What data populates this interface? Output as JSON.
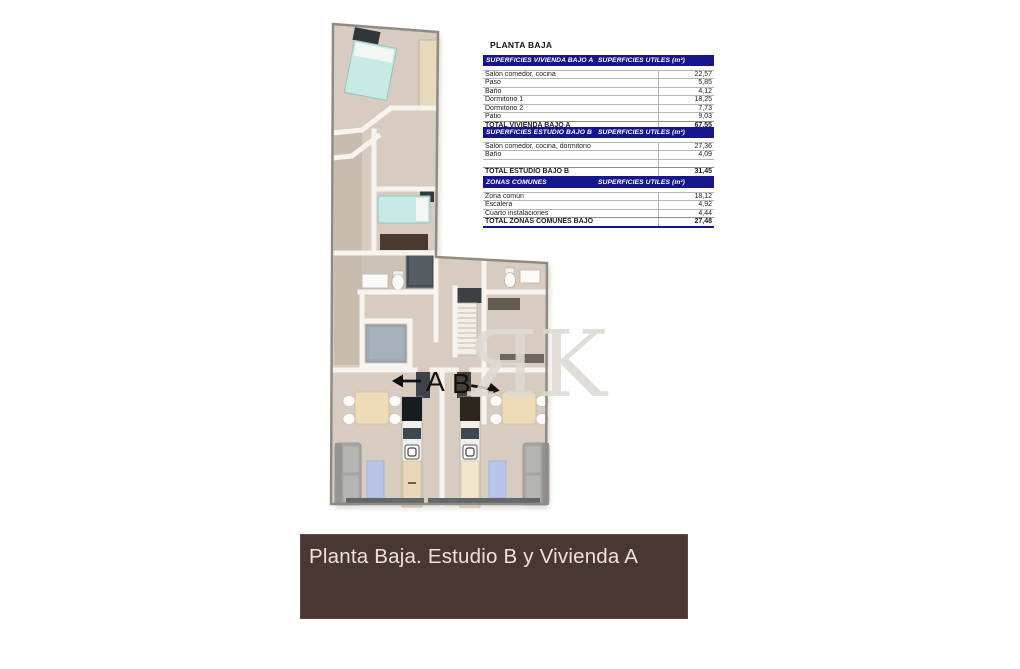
{
  "title": "PLANTA BAJA",
  "plan": {
    "unit_a_label": "A",
    "unit_b_label": "B",
    "watermark": "ЯK"
  },
  "tables": [
    {
      "header_left": "SUPERFICIES VIVIENDA BAJO A",
      "header_right": "SUPERFICIES UTILES  (m²)",
      "rows": [
        {
          "label": "Salón comedor, cocina",
          "value": "22,57"
        },
        {
          "label": "Paso",
          "value": "5,85"
        },
        {
          "label": "Baño",
          "value": "4,12"
        },
        {
          "label": "Dormitorio 1",
          "value": "18,25"
        },
        {
          "label": "Dormitorio 2",
          "value": "7,73"
        },
        {
          "label": "Patio",
          "value": "9,03"
        }
      ],
      "total": {
        "label": "TOTAL VIVIENDA BAJO A",
        "value": "67,55"
      }
    },
    {
      "header_left": "SUPERFICIES ESTUDIO BAJO B",
      "header_right": "SUPERFICIES UTILES  (m²)",
      "rows": [
        {
          "label": "Salón comedor, cocina, dormitorio",
          "value": "27,36"
        },
        {
          "label": "Baño",
          "value": "4,09"
        },
        {
          "label": "",
          "value": ""
        }
      ],
      "total": {
        "label": "TOTAL ESTUDIO BAJO B",
        "value": "31,45"
      }
    },
    {
      "header_left": "ZONAS COMUNES",
      "header_right": "SUPERFICIES UTILES  (m²)",
      "rows": [
        {
          "label": "Zona común",
          "value": "18,12"
        },
        {
          "label": "Escalera",
          "value": "4,92"
        },
        {
          "label": "Cuarto instalaciones",
          "value": "4,44"
        }
      ],
      "total": {
        "label": "TOTAL ZONAS COMUNES BAJO",
        "value": "27,48"
      }
    }
  ],
  "banner": {
    "text": "Planta Baja. Estudio B y Vivienda A"
  },
  "colors": {
    "table_header_bg": "#15158e",
    "banner_bg": "#4b3731",
    "banner_fg": "#ebe3da",
    "floor": "#d7ccbf",
    "bed_teal": "#c6eae6",
    "patio_gray": "#9fabb6",
    "rug_blue": "#b7c6e6"
  }
}
